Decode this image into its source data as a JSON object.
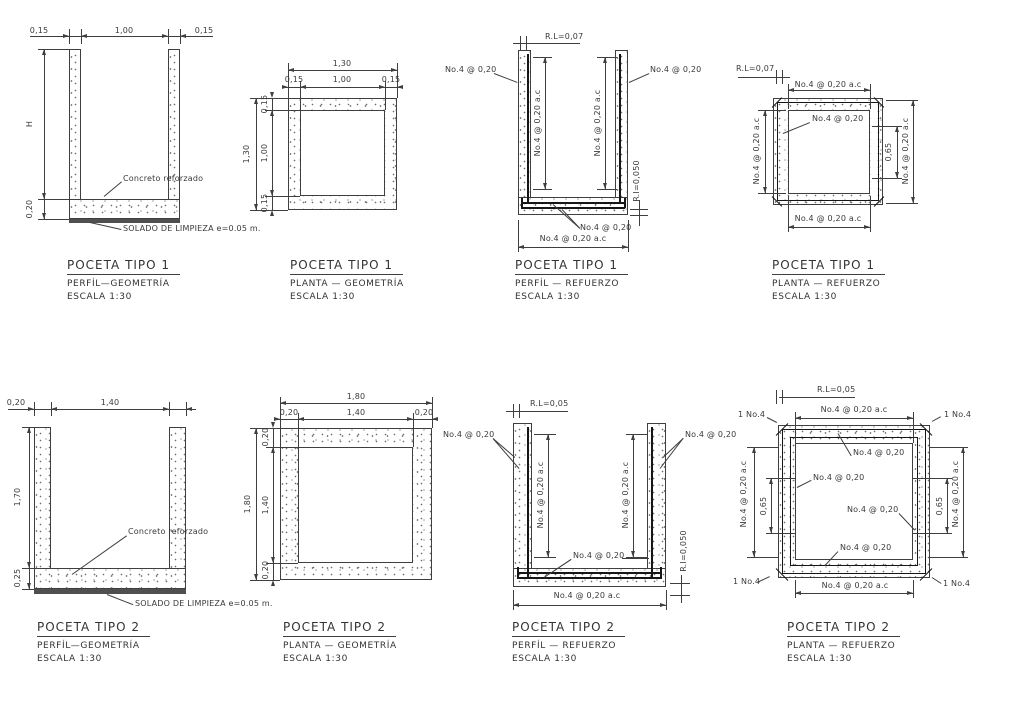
{
  "sheet": {
    "bg": "#ffffff",
    "line_color": "#3f3f3f",
    "rebar_color": "#161616",
    "solado_color": "#4f4f4f"
  },
  "t1": {
    "perfil_geo": {
      "title": "POCETA TIPO 1",
      "subtitle": "PERFÍL—GEOMETRÍA",
      "scale": "ESCALA 1:30",
      "dim_top": [
        "0,15",
        "1,00",
        "0,15"
      ],
      "dim_height": "H",
      "dim_slab": "0,20",
      "note_concrete": "Concreto reforzado",
      "note_solado": "SOLADO DE LIMPIEZA e=0.05 m."
    },
    "planta_geo": {
      "title": "POCETA TIPO 1",
      "subtitle": "PLANTA — GEOMETRÍA",
      "scale": "ESCALA 1:30",
      "dim_total_top": "1,30",
      "dim_top": [
        "0,15",
        "1,00",
        "0,15"
      ],
      "dim_total_left": "1,30",
      "dim_left": [
        "0,15",
        "1,00",
        "0,15"
      ]
    },
    "perfil_ref": {
      "title": "POCETA TIPO 1",
      "subtitle": "PERFÍL — REFUERZO",
      "scale": "ESCALA 1:30",
      "cover_top": "R.L=0,07",
      "cover_bottom": "R.I=0,050",
      "callout_left": "No.4 @ 0,20",
      "callout_right": "No.4 @ 0,20",
      "vert_left": "No.4 @ 0,20 a.c",
      "vert_right": "No.4 @ 0,20 a.c",
      "callout_slab": "No.4 @ 0,20",
      "dim_bottom": "No.4 @ 0,20 a.c"
    },
    "planta_ref": {
      "title": "POCETA TIPO 1",
      "subtitle": "PLANTA — REFUERZO",
      "scale": "ESCALA 1:30",
      "cover_top": "R.L=0,07",
      "dim_top": "No.4 @ 0,20 a.c",
      "dim_left": "No.4 @ 0,20 a.c",
      "dim_right": "No.4 @ 0,20 a.c",
      "dim_bottom": "No.4 @ 0,20 a.c",
      "callout_inner": "No.4 @ 0,20",
      "dim_spacing": "0,65"
    }
  },
  "t2": {
    "perfil_geo": {
      "title": "POCETA TIPO 2",
      "subtitle": "PERFÍL—GEOMETRÍA",
      "scale": "ESCALA 1:30",
      "dim_top": [
        "0,20",
        "1,40"
      ],
      "dim_height": "1,70",
      "dim_slab": "0,25",
      "note_concrete": "Concreto reforzado",
      "note_solado": "SOLADO DE LIMPIEZA e=0.05 m."
    },
    "planta_geo": {
      "title": "POCETA TIPO 2",
      "subtitle": "PLANTA — GEOMETRÍA",
      "scale": "ESCALA 1:30",
      "dim_total_top": "1,80",
      "dim_top": [
        "0,20",
        "1,40",
        "0,20"
      ],
      "dim_total_left": "1,80",
      "dim_left": [
        "0,20",
        "1,40",
        "0,20"
      ]
    },
    "perfil_ref": {
      "title": "POCETA TIPO 2",
      "subtitle": "PERFÍL — REFUERZO",
      "scale": "ESCALA 1:30",
      "cover_top": "R.L=0,05",
      "cover_bottom": "R.I=0,050",
      "callout_left": "No.4 @ 0,20",
      "callout_right": "No.4 @ 0,20",
      "vert_left": "No.4 @ 0,20 a.c",
      "vert_right": "No.4 @ 0,20 a.c",
      "callout_slab": "No.4 @ 0,20",
      "dim_bottom": "No.4 @ 0,20 a.c"
    },
    "planta_ref": {
      "title": "POCETA TIPO 2",
      "subtitle": "PLANTA — REFUERZO",
      "scale": "ESCALA 1:30",
      "cover_top": "R.L=0,05",
      "dim_top": "No.4 @ 0,20 a.c",
      "dim_left": "No.4 @ 0,20 a.c",
      "dim_right": "No.4 @ 0,20 a.c",
      "dim_bottom": "No.4 @ 0,20 a.c",
      "corners": [
        "1 No.4",
        "1 No.4",
        "1 No.4",
        "1 No.4"
      ],
      "callouts": [
        "No.4 @ 0,20",
        "No.4 @ 0,20",
        "No.4 @ 0,20",
        "No.4 @ 0,20"
      ],
      "spacing": [
        "0,65",
        "0,65"
      ]
    }
  }
}
